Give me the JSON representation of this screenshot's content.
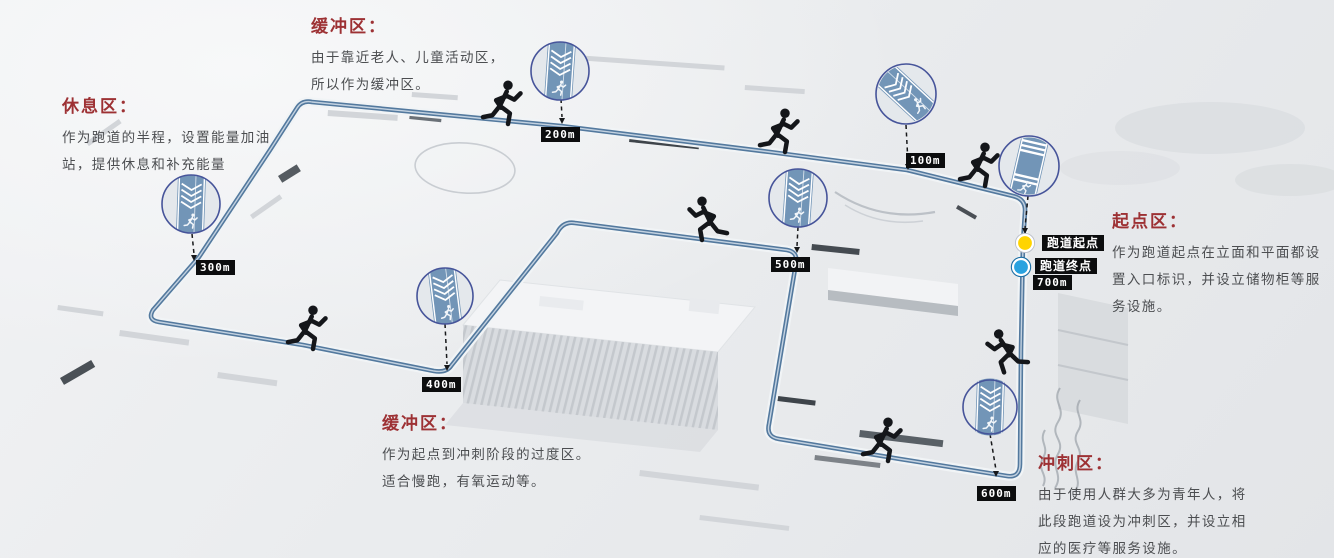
{
  "zones": {
    "buffer_top": {
      "title": "缓冲区：",
      "lines": [
        "由于靠近老人、儿童活动区，",
        "所以作为缓冲区。"
      ]
    },
    "rest": {
      "title": "休息区：",
      "lines": [
        "作为跑道的半程，设置能量加油",
        "站，提供休息和补充能量"
      ]
    },
    "start": {
      "title": "起点区：",
      "lines": [
        "作为跑道起点在立面和平面都设",
        "置入口标识，并设立储物柜等服",
        "务设施。"
      ]
    },
    "buffer_bottom": {
      "title": "缓冲区：",
      "lines": [
        "作为起点到冲刺阶段的过度区。",
        "适合慢跑，有氧运动等。"
      ]
    },
    "sprint": {
      "title": "冲刺区：",
      "lines": [
        "由于使用人群大多为青年人，将",
        "此段跑道设为冲刺区，并设立相",
        "应的医疗等服务设施。"
      ]
    }
  },
  "markers": {
    "m100": "100m",
    "m200": "200m",
    "m300": "300m",
    "m400": "400m",
    "m500": "500m",
    "m600": "600m",
    "m700": "700m"
  },
  "track_points": {
    "start_label": "跑道起点",
    "finish_label": "跑道终点"
  },
  "colors": {
    "track_blue": "#53799e",
    "zone_title_red": "#9d3134",
    "badge_black": "#0c0d0e",
    "start_dot_yellow": "#ffd400",
    "finish_dot_blue": "#2aa2df",
    "inset_band_blue": "#7295b7"
  }
}
